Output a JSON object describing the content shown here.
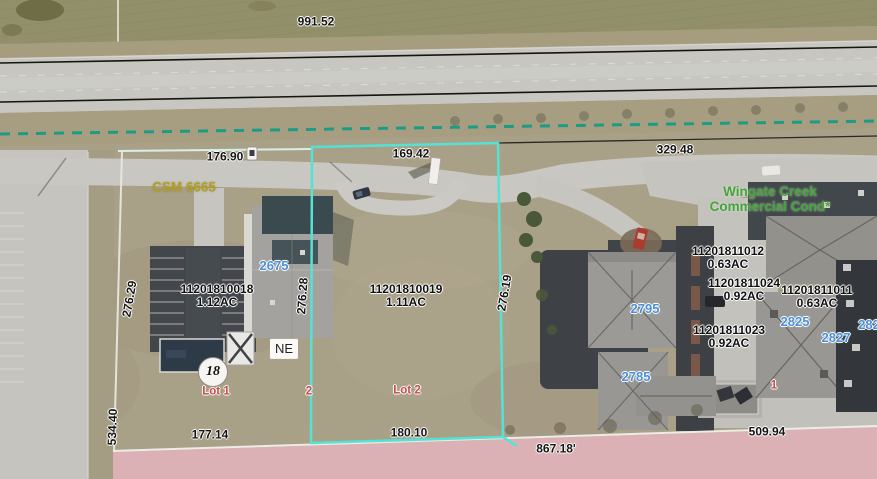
{
  "map": {
    "dimension_labels": [
      {
        "text": "991.52"
      },
      {
        "text": "176.90"
      },
      {
        "text": "169.42"
      },
      {
        "text": "329.48"
      },
      {
        "text": "276.29"
      },
      {
        "text": "276.28"
      },
      {
        "text": "276.19"
      },
      {
        "text": "534.40"
      },
      {
        "text": "177.14"
      },
      {
        "text": "180.10"
      },
      {
        "text": "867.18'"
      },
      {
        "text": "509.94"
      }
    ],
    "parcel_labels": [
      {
        "id": "11201810018",
        "area": "1.12AC"
      },
      {
        "id": "11201810019",
        "area": "1.11AC"
      },
      {
        "id": "11201811012",
        "area": "0.63AC"
      },
      {
        "id": "11201811024",
        "area": "0.92AC"
      },
      {
        "id": "11201811011",
        "area": "0.63AC"
      },
      {
        "id": "11201811023",
        "area": "0.92AC"
      }
    ],
    "address_labels": [
      {
        "text": "2675"
      },
      {
        "text": "2795"
      },
      {
        "text": "2785"
      },
      {
        "text": "2825"
      },
      {
        "text": "2827"
      },
      {
        "text": "282"
      }
    ],
    "lot_labels": [
      {
        "text": "Lot 1"
      },
      {
        "text": "Lot 2"
      },
      {
        "text": "2"
      },
      {
        "text": "1"
      }
    ],
    "survey_label": {
      "text": "CSM 6665"
    },
    "condo_label": {
      "line1": "Wingate Creek",
      "line2": "Commercial Cond*"
    },
    "direction_box": {
      "text": "NE"
    },
    "highway_shield": {
      "text": "18"
    },
    "colors": {
      "selected_parcel_outline": "#55e2d4",
      "section_line_dashed": "#1c9c84",
      "row_lines": "#15150f",
      "highlight_parcel_fill": "#e3b3bb",
      "address_label": "#4b8fd9",
      "lot_label": "#c64a4a",
      "condo_label": "#47a33b",
      "survey_label": "#b2a01e",
      "dimension_label": "#141414"
    }
  }
}
